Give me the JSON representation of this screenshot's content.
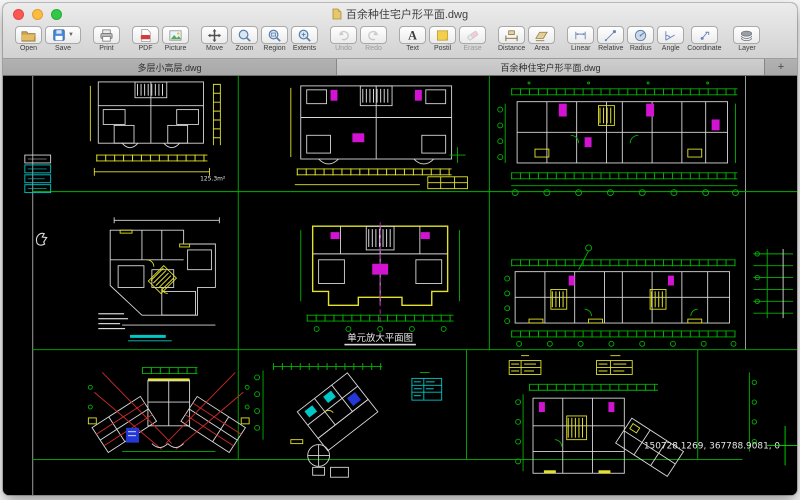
{
  "window": {
    "title": "百余种住宅户形平面.dwg"
  },
  "toolbar": {
    "buttons": [
      {
        "label": "Open",
        "disabled": false
      },
      {
        "label": "Save",
        "disabled": false
      },
      {
        "label": "Print",
        "disabled": false
      },
      {
        "label": "PDF",
        "disabled": false
      },
      {
        "label": "Picture",
        "disabled": false
      },
      {
        "label": "Move",
        "disabled": false
      },
      {
        "label": "Zoom",
        "disabled": false
      },
      {
        "label": "Region",
        "disabled": false
      },
      {
        "label": "Extents",
        "disabled": false
      },
      {
        "label": "Undo",
        "disabled": true
      },
      {
        "label": "Redo",
        "disabled": true
      },
      {
        "label": "Text",
        "disabled": false
      },
      {
        "label": "Postil",
        "disabled": false
      },
      {
        "label": "Erase",
        "disabled": true
      },
      {
        "label": "Distance",
        "disabled": false
      },
      {
        "label": "Area",
        "disabled": false
      },
      {
        "label": "Linear",
        "disabled": false
      },
      {
        "label": "Relative",
        "disabled": false
      },
      {
        "label": "Radius",
        "disabled": false
      },
      {
        "label": "Angle",
        "disabled": false
      },
      {
        "label": "Coordinate",
        "disabled": false
      },
      {
        "label": "Layer",
        "disabled": false
      }
    ]
  },
  "tabs": {
    "items": [
      {
        "label": "多层小高层.dwg",
        "active": false
      },
      {
        "label": "百余种住宅户形平面.dwg",
        "active": true
      }
    ],
    "add_label": "+"
  },
  "canvas": {
    "labels": {
      "area_top_left": "125.3m²",
      "caption_center": "单元放大平面图",
      "cursor_coordinates": "150728.1269, 367788.9081, 0"
    },
    "colors": {
      "background": "#000000",
      "grid_line": "#00b400",
      "wall": "#d9d9d9",
      "dimension_yellow": "#e3e32a",
      "accent_magenta": "#d214d2",
      "accent_red": "#cf2a2a",
      "accent_cyan": "#00c8c8",
      "accent_blue": "#2438d8"
    }
  }
}
